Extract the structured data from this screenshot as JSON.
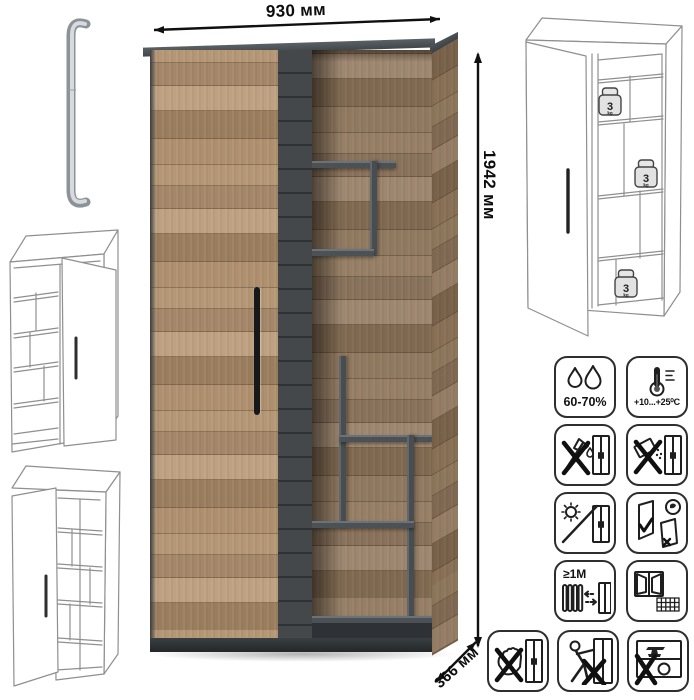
{
  "dimensions": {
    "width": "930 мм",
    "height": "1942 мм",
    "depth": "366 мм"
  },
  "load_badge": {
    "value": "3",
    "unit": "kg"
  },
  "care_icons": [
    {
      "name": "humidity-icon",
      "label": "60-70%"
    },
    {
      "name": "temperature-icon",
      "label": "+10...+25⁰C"
    },
    {
      "name": "no-sharp-tools-icon"
    },
    {
      "name": "no-abrasive-powder-icon"
    },
    {
      "name": "no-direct-sunlight-icon"
    },
    {
      "name": "door-adjustment-icon"
    },
    {
      "name": "radiator-distance-icon",
      "label": "≥1М"
    },
    {
      "name": "window-ventilation-icon"
    },
    {
      "name": "no-hand-pressure-icon"
    },
    {
      "name": "no-pushing-icon"
    },
    {
      "name": "no-heavy-load-icon"
    }
  ],
  "colors": {
    "wood": "#ad8f6e",
    "wood_seam": "#8c7153",
    "anthracite": "#42474b",
    "line_art": "#8f8f8f",
    "dimension": "#101010"
  }
}
